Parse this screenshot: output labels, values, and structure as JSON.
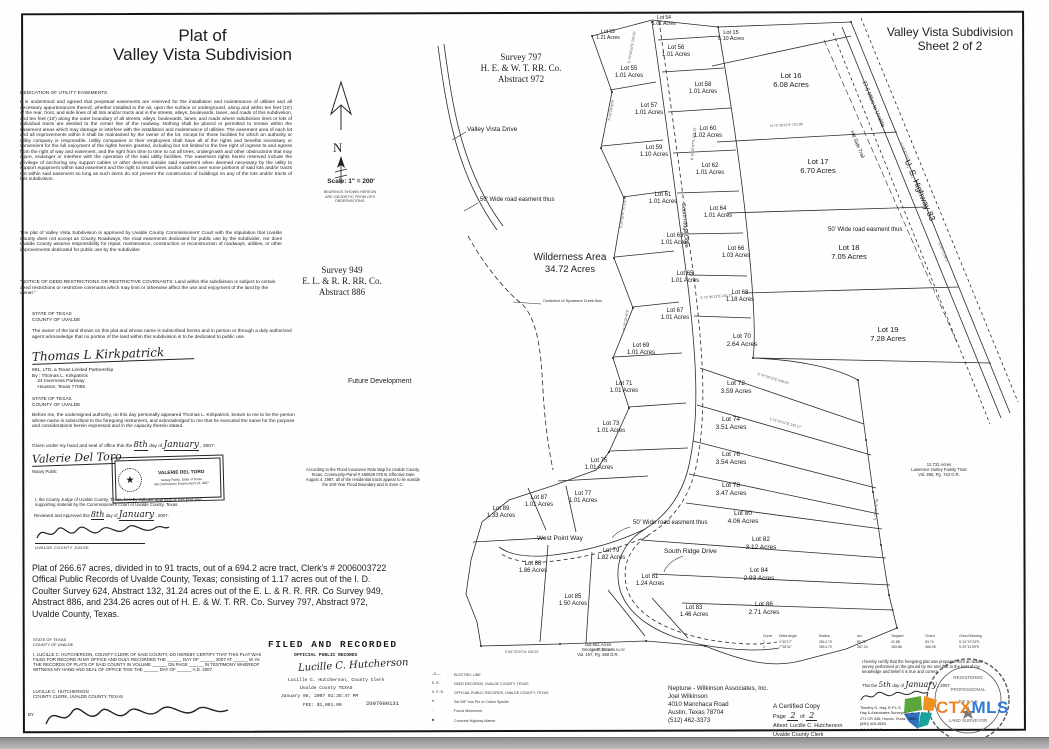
{
  "header": {
    "plat_title_line1": "Plat of",
    "plat_title_line2": "Valley Vista Subdivision",
    "sheet_title_line1": "Valley Vista Subdivision",
    "sheet_title_line2": "Sheet 2 of 2"
  },
  "compass": {
    "letter": "N",
    "scale_label": "Scale: 1\" = 200'",
    "bearings_note": "BEARINGS SHOWN HEREON\nARE GEODETIC FROM GPS\nOBSERVATIONS."
  },
  "surveys": {
    "s797_line1": "Survey 797",
    "s797_line2": "H. E. & W. T. RR. Co.",
    "s797_line3": "Abstract 972",
    "s949_line1": "Survey 949",
    "s949_line2": "E. L. & R. R. RR. Co.",
    "s949_line3": "Abstract 886"
  },
  "legal": {
    "dedication_heading": "DEDICATION OF UTILITY EASEMENTS",
    "dedication_body": "It is understood and agreed that perpetual easements are reserved for the installation and maintenance of utilities and all necessary appurtenances thereof, whether installed in the air, upon the surface or underground, along and within ten feet (10') of the rear, front, and side lines of all lots and/or tracts and in the streets, alleys, boulevards, lanes, and roads of this subdivision, and ten feet (10') along the outer boundary of all streets, alleys, boulevards, lanes, and roads where subdivision lines or lots of individual tracts are deeded to the center line of the roadway. Nothing shall be placed or permitted to remain within the easement areas which may damage or interfere with the installation and maintenance of utilities. The easement area of each lot and all improvements within it shall be maintained by the owner of the lot, except for those facilities for which an authority or utility company is responsible. Utility companies or their employees shall have all of the rights and benefits necessary or convenient for the full enjoyment of the rights herein granted, including but not limited to the free right of ingress to and egress from the right of way and easement, and the right from time to time to cut all trees, undergrowth and other obstructions that may injure, endanger or interfere with the operation of the said utility facilities. The easement rights herein reserved include the privilege of anchoring any support cables or other devices outside said easement when deemed necessary by the utility to support equipment within said easement and the right to install wires and/or cables over some portions of said lots and/or tracts not within said easement so long as such items do not prevent the construction of buildings on any of the lots and/or tracts of this subdivision.",
    "approval_body": "The plat of Valley Vista Subdivision is approved by Uvalde County Commissioners' Court with the stipulation that Uvalde County does not accept as County Roadways, the road easements dedicated for public use by the subdivider, nor does Uvalde County assume responsibility for repair, maintenance, construction or reconstruction of roadways, utilities, or other improvements dedicated for public use by the subdivider.",
    "notice_body": "\"NOTICE OF DEED RESTRICTIONS OR RESTRICTIVE COVENANTS:  Land within this subdivision is subject to certain deed restrictions or restrictive covenants which may limit or otherwise affect the use and enjoyment of the land by the owner.\"",
    "state_of_texas": "STATE OF TEXAS",
    "county_of_uvalde": "COUNTY OF UVALDE",
    "owner_body": "The owner of the land shown on this plat and whose name is subscribed hereto and in person or through a duly authorized agent acknowledge that no portion of the land within this subdivision is to be dedicated to public use.",
    "owner_signature": "Thomas L Kirkpatrick",
    "owner_company": "691, LTD, a Texas Limited Partnership",
    "owner_by": "By : Thomas L. Kirkpatrick",
    "owner_addr1": "    24 Inverness Parkway",
    "owner_addr2": "    Houston, Texas 77055",
    "notary_body": "Before me, the undersigned authority, on this day personally appeared Thomas L. Kirkpatrick, known to me to be the person whose name is subscribed to the foregoing instrument, and acknowledged to me that he executed the same for the purpose and considerations herein expressed and in the capacity therein stated.",
    "given_prefix": "Given under my hand and seal of office this the",
    "given_day": "8th",
    "given_mid": "day of",
    "given_month": "January",
    "given_suffix": ", 2007.",
    "notary_signature": "Valerie Del Toro",
    "notary_public_label": "Notary Public",
    "stamp_name": "VALERIE DEL TORO",
    "stamp_line2": "Notary Public, State of Texas",
    "stamp_line3": "My Commission Expires April 13, 2007",
    "judge_body": "I, the County Judge of Uvalde County, Texas, hereby indicate approval of this plat and supporting material by the Commissioners Court of Uvalde County, Texas.",
    "reviewed_prefix": "Reviewed and Approved this",
    "reviewed_day": "8th",
    "reviewed_mid": "day of",
    "reviewed_month": "January",
    "reviewed_suffix": ", 2007.",
    "judge_title": "UVALDE COUNTY JUDGE",
    "flood_note": "According to the Flood Insurance Rate Map for Uvalde County,\nTexas, Community-Panel # 480629 075 B, Effective Date\nAugust 4, 1987, all of the residential tracts appear to lie outside\nthe 100-Year Flood Boundary and in Zone C.",
    "plat_summary": "Plat of 266.67 acres, divided in to 91 tracts, out of a 694.2 acre tract, Clerk's # 2006003722 Offical Public Records of Uvalde County, Texas; consisting of 1.17 acres out of the I. D. Coulter Survey 624, Abstract 132, 31.24 acres out of the E. L. & R. R. RR. Co Survey 949, Abstract 886, and 234.26 acres out of H. E. & W. T. RR. Co. Survey 797, Abstract 972, Uvalde County, Texas.",
    "clerk_cert_body": "I, LUCILLE C. HUTCHERSON, COUNTY CLERK OF SAID COUNTY, DO HEREBY CERTIFY THAT THIS PLAT WAS FILED FOR RECORD IN MY OFFICE AND DULY RECORDED THE ______ DAY OF ______ 2007 AT ______ M. IN THE RECORDS OF PLATS OF SAID COUNTY IN VOLUME ______ ON PAGE ______ IN TESTIMONY WHEREOF WITNESS MY HAND AND SEAL OF OFFICE THIS THE ______ DAY OF ______ A.D. 2007.",
    "clerk_name": "LUCILLE C. HUTCHERSON",
    "clerk_title": "COUNTY CLERK, UVALDE COUNTY, TEXAS",
    "clerk_by": "BY",
    "clerk_signature": "Lucille C. Hutcherson"
  },
  "map": {
    "wilderness_line1": "Wilderness Area",
    "wilderness_line2": "34.72 Acres",
    "creek_label": "Centerline of Sycamore Creek thus",
    "future_dev": "Future Development",
    "hurley": "12.731 Acres\nLawrence Hurley Family Trust\nVol. 395, Pg. 743 O.R.",
    "brown": "118.952 Acres\nGeorge R. Brown\nVol. 197, Pg. 658 D.R.",
    "road_labels": [
      {
        "text": "Valley Vista Drive",
        "x": 467,
        "y": 126,
        "rot": 0,
        "fs": 6.5
      },
      {
        "text": "50' Wide road easment thus",
        "x": 480,
        "y": 197,
        "rot": 0,
        "fs": 6
      },
      {
        "text": "50' Wide road easment thus",
        "x": 828,
        "y": 227,
        "rot": 0,
        "fs": 6
      },
      {
        "text": "50' Wide road easment thus",
        "x": 633,
        "y": 520,
        "rot": 0,
        "fs": 6
      },
      {
        "text": "South Ridge Drive",
        "x": 686,
        "y": 203,
        "rot": 86,
        "fs": 5.5
      },
      {
        "text": "South Ridge Drive",
        "x": 664,
        "y": 548,
        "rot": 0,
        "fs": 6.5
      },
      {
        "text": "West Point Way",
        "x": 537,
        "y": 535,
        "rot": 0,
        "fs": 6.5
      },
      {
        "text": "27.5 Miles to Uvalde",
        "x": 866,
        "y": 80,
        "rot": 67,
        "fs": 5.5
      },
      {
        "text": "Hill Side Trail",
        "x": 854,
        "y": 130,
        "rot": 67,
        "fs": 5
      },
      {
        "text": "U. S. Highway 83",
        "x": 912,
        "y": 158,
        "rot": 67,
        "fs": 8.5
      }
    ],
    "lots": [
      {
        "name": "Lot 53",
        "acres": "1.21 Acres",
        "x": 608,
        "y": 30,
        "fs": 5
      },
      {
        "name": "Lot 54",
        "acres": "1.01 Acres",
        "x": 664,
        "y": 16,
        "fs": 5
      },
      {
        "name": "Lot 55",
        "acres": "1.01 Acres",
        "x": 629,
        "y": 66,
        "fs": 6
      },
      {
        "name": "Lot 56",
        "acres": "1.01 Acres",
        "x": 676,
        "y": 45,
        "fs": 6
      },
      {
        "name": "Lot 15",
        "acres": "5.10 Acres",
        "x": 731,
        "y": 30,
        "fs": 5.5
      },
      {
        "name": "Lot 16",
        "acres": "6.08 Acres",
        "x": 791,
        "y": 72,
        "fs": 7.5
      },
      {
        "name": "Lot 57",
        "acres": "1.01 Acres",
        "x": 649,
        "y": 103,
        "fs": 6
      },
      {
        "name": "Lot 58",
        "acres": "1.01 Acres",
        "x": 703,
        "y": 82,
        "fs": 6
      },
      {
        "name": "Lot 59",
        "acres": "1.10 Acres",
        "x": 654,
        "y": 145,
        "fs": 6
      },
      {
        "name": "Lot 60",
        "acres": "1.02 Acres",
        "x": 708,
        "y": 126,
        "fs": 6
      },
      {
        "name": "Lot 17",
        "acres": "6.70 Acres",
        "x": 818,
        "y": 158,
        "fs": 7.5
      },
      {
        "name": "Lot 62",
        "acres": "1.01 Acres",
        "x": 710,
        "y": 163,
        "fs": 6
      },
      {
        "name": "Lot 61",
        "acres": "1.01 Acres",
        "x": 663,
        "y": 192,
        "fs": 6
      },
      {
        "name": "Lot 64",
        "acres": "1.01 Acres",
        "x": 718,
        "y": 206,
        "fs": 6
      },
      {
        "name": "Lot 63",
        "acres": "1.01 Acres",
        "x": 675,
        "y": 233,
        "fs": 6
      },
      {
        "name": "Lot 66",
        "acres": "1.03 Acres",
        "x": 736,
        "y": 246,
        "fs": 6
      },
      {
        "name": "Lot 65",
        "acres": "1.01 Acres",
        "x": 685,
        "y": 271,
        "fs": 6
      },
      {
        "name": "Lot 68",
        "acres": "1.18 Acres",
        "x": 740,
        "y": 290,
        "fs": 6
      },
      {
        "name": "Lot 18",
        "acres": "7.05 Acres",
        "x": 849,
        "y": 244,
        "fs": 7.5
      },
      {
        "name": "Lot 67",
        "acres": "1.01 Acres",
        "x": 675,
        "y": 308,
        "fs": 6
      },
      {
        "name": "Lot 70",
        "acres": "2.64 Acres",
        "x": 742,
        "y": 333,
        "fs": 6.5
      },
      {
        "name": "Lot 19",
        "acres": "7.28 Acres",
        "x": 888,
        "y": 326,
        "fs": 7.5
      },
      {
        "name": "Lot 69",
        "acres": "1.01 Acres",
        "x": 641,
        "y": 343,
        "fs": 6
      },
      {
        "name": "Lot 72",
        "acres": "3.59 Acres",
        "x": 736,
        "y": 380,
        "fs": 6.5
      },
      {
        "name": "Lot 71",
        "acres": "1.01 Acres",
        "x": 624,
        "y": 381,
        "fs": 6
      },
      {
        "name": "Lot 74",
        "acres": "3.51 Acres",
        "x": 731,
        "y": 416,
        "fs": 6.5
      },
      {
        "name": "Lot 73",
        "acres": "1.01 Acres",
        "x": 611,
        "y": 421,
        "fs": 6
      },
      {
        "name": "Lot 76",
        "acres": "3.54 Acres",
        "x": 731,
        "y": 451,
        "fs": 6.5
      },
      {
        "name": "Lot 75",
        "acres": "1.01 Acres",
        "x": 599,
        "y": 458,
        "fs": 6
      },
      {
        "name": "Lot 78",
        "acres": "3.47 Acres",
        "x": 731,
        "y": 482,
        "fs": 6.5
      },
      {
        "name": "Lot 77",
        "acres": "1.01 Acres",
        "x": 583,
        "y": 491,
        "fs": 6
      },
      {
        "name": "Lot 80",
        "acres": "4.06 Acres",
        "x": 743,
        "y": 510,
        "fs": 6.5
      },
      {
        "name": "Lot 87",
        "acres": "1.01 Acres",
        "x": 539,
        "y": 495,
        "fs": 6
      },
      {
        "name": "Lot 89",
        "acres": "1.33 Acres",
        "x": 501,
        "y": 506,
        "fs": 6
      },
      {
        "name": "Lot 82",
        "acres": "3.12 Acres",
        "x": 761,
        "y": 536,
        "fs": 6.5
      },
      {
        "name": "Lot 79",
        "acres": "1.82 Acres",
        "x": 611,
        "y": 548,
        "fs": 6
      },
      {
        "name": "Lot 84",
        "acres": "2.93 Acres",
        "x": 759,
        "y": 567,
        "fs": 6.5
      },
      {
        "name": "Lot 88",
        "acres": "1.86 Acres",
        "x": 533,
        "y": 561,
        "fs": 6
      },
      {
        "name": "Lot 81",
        "acres": "1.24 Acres",
        "x": 650,
        "y": 574,
        "fs": 6
      },
      {
        "name": "Lot 85",
        "acres": "1.50 Acres",
        "x": 573,
        "y": 594,
        "fs": 6
      },
      {
        "name": "Lot 83",
        "acres": "1.46 Acres",
        "x": 694,
        "y": 605,
        "fs": 6
      },
      {
        "name": "Lot 86",
        "acres": "2.71 Acres",
        "x": 764,
        "y": 601,
        "fs": 6.5
      }
    ],
    "bearing_ticks": [
      {
        "t": "S 70°50'10\"E 202.62'",
        "x": 627,
        "y": 63,
        "r": -80
      },
      {
        "t": "N 15°28'40\"E",
        "x": 607,
        "y": 120,
        "r": -78
      },
      {
        "t": "N 15°20'47\"E 205.10'",
        "x": 690,
        "y": 160,
        "r": -85
      },
      {
        "t": "S 15°36'47\"W 226.51'",
        "x": 619,
        "y": 228,
        "r": -82
      },
      {
        "t": "S 73°36'13\"E 240.17'",
        "x": 700,
        "y": 296,
        "r": -5
      },
      {
        "t": "N 15°28'40\"E",
        "x": 622,
        "y": 330,
        "r": -80
      },
      {
        "t": "S 74°39'13\"E 249.50'",
        "x": 758,
        "y": 372,
        "r": 17
      },
      {
        "t": "S 74°23'12\"E 232.17'",
        "x": 770,
        "y": 417,
        "r": 15
      },
      {
        "t": "N 74°39'13\"E 763.98'",
        "x": 770,
        "y": 124,
        "r": -3
      },
      {
        "t": "S 24°47'23\"E",
        "x": 903,
        "y": 142,
        "r": 67
      },
      {
        "t": "S 20°11'59\"E",
        "x": 941,
        "y": 242,
        "r": 67
      },
      {
        "t": "S 15°36'47\"W",
        "x": 873,
        "y": 520,
        "r": -84
      },
      {
        "t": "S 86°32'53\"W 165.25'",
        "x": 505,
        "y": 650,
        "r": 0
      },
      {
        "t": "N 86°36'53\"E 184.59'",
        "x": 592,
        "y": 648,
        "r": 0
      }
    ]
  },
  "legend": {
    "items": [
      {
        "symbol": "—E——",
        "label": "ELECTRIC LINE"
      },
      {
        "symbol": "D.R.",
        "label": "DEED RECORDS, UVALDE COUNTY, TEXAS"
      },
      {
        "symbol": "O.P.R.",
        "label": "OFFICIAL PUBLIC RECORDS, UVALDE COUNTY, TEXAS"
      },
      {
        "symbol": "●",
        "label": "Set 5/8\" Iron Pin or Cotton Spindle"
      },
      {
        "symbol": "◦",
        "label": "Found Monument"
      },
      {
        "symbol": "■",
        "label": "Concrete Highway Marker"
      }
    ]
  },
  "filed_block": {
    "title": "FILED AND RECORDED",
    "subtitle": "OFFICIAL PUBLIC RECORDS",
    "signature": "Lucille C. Hutcherson",
    "clerk_line": "Lucille C. Hutcherson, County Clerk",
    "county_line": "Uvalde County TEXAS",
    "datetime": "January 08, 2007 01:35:47 PM",
    "fee": "FEE: $1,091.00",
    "instrument": "2007000131"
  },
  "curve_table": {
    "headers": [
      "Curve",
      "Delta Angle",
      "Radius",
      "Arc",
      "Tangent",
      "Chord",
      "Chord Bearing"
    ],
    "rows": [
      [
        "1",
        "1°40'17\"",
        "2814.79",
        "83.75",
        "41.88",
        "83.74",
        "S 24°47'23\"E"
      ],
      [
        "2",
        "7°28'31\"",
        "2814.79",
        "367.24",
        "183.88",
        "366.98",
        "S 20°11'59\"E"
      ]
    ]
  },
  "surveyor": {
    "cert_body": "I hereby certify that the foregoing plat was prepared from an actual survey performed on the ground by me and that to the best of my knowledge and belief it is true and correct.",
    "date_prefix": "This the",
    "date_day": "5th",
    "date_mid": "day of",
    "date_month": "January",
    "date_suffix": ", 2007.",
    "info_lines": [
      "Timothy G. Hay, R.P.L.S.",
      "Hay & Associates Surveying Co.",
      "271 CR 446, Hondo, Texas 78861",
      "(830) 426-8553",
      "Job # 6104-0"
    ],
    "seal_word1": "REGISTERED",
    "seal_word2": "PROFESSIONAL",
    "seal_word3": "LAND SURVEYOR",
    "seal_state": "T E X A S"
  },
  "certified": {
    "line1": "A Certified Copy",
    "page_label": "Page",
    "page_num": "2",
    "of_label": "of",
    "page_total": "2",
    "line3": "Attest: Lucille C. Hutcherson",
    "line4": "Uvalde County Clerk"
  },
  "neptune": {
    "lines": [
      "Neptune - Wilkinson Associates, Inc.",
      "Joel Wilkinson",
      "4010 Manchaca Road",
      "Austin, Texas 78704",
      "(512) 462-3373"
    ]
  },
  "logo": {
    "ctx": "CTX",
    "mls": "MLS",
    "colors": {
      "green": "#5aa63a",
      "orange": "#f0921e",
      "blue": "#2e6fc0",
      "teal": "#18a39b",
      "ctx_orange": "#e8872a",
      "mls_blue": "#2f7bd6"
    }
  }
}
